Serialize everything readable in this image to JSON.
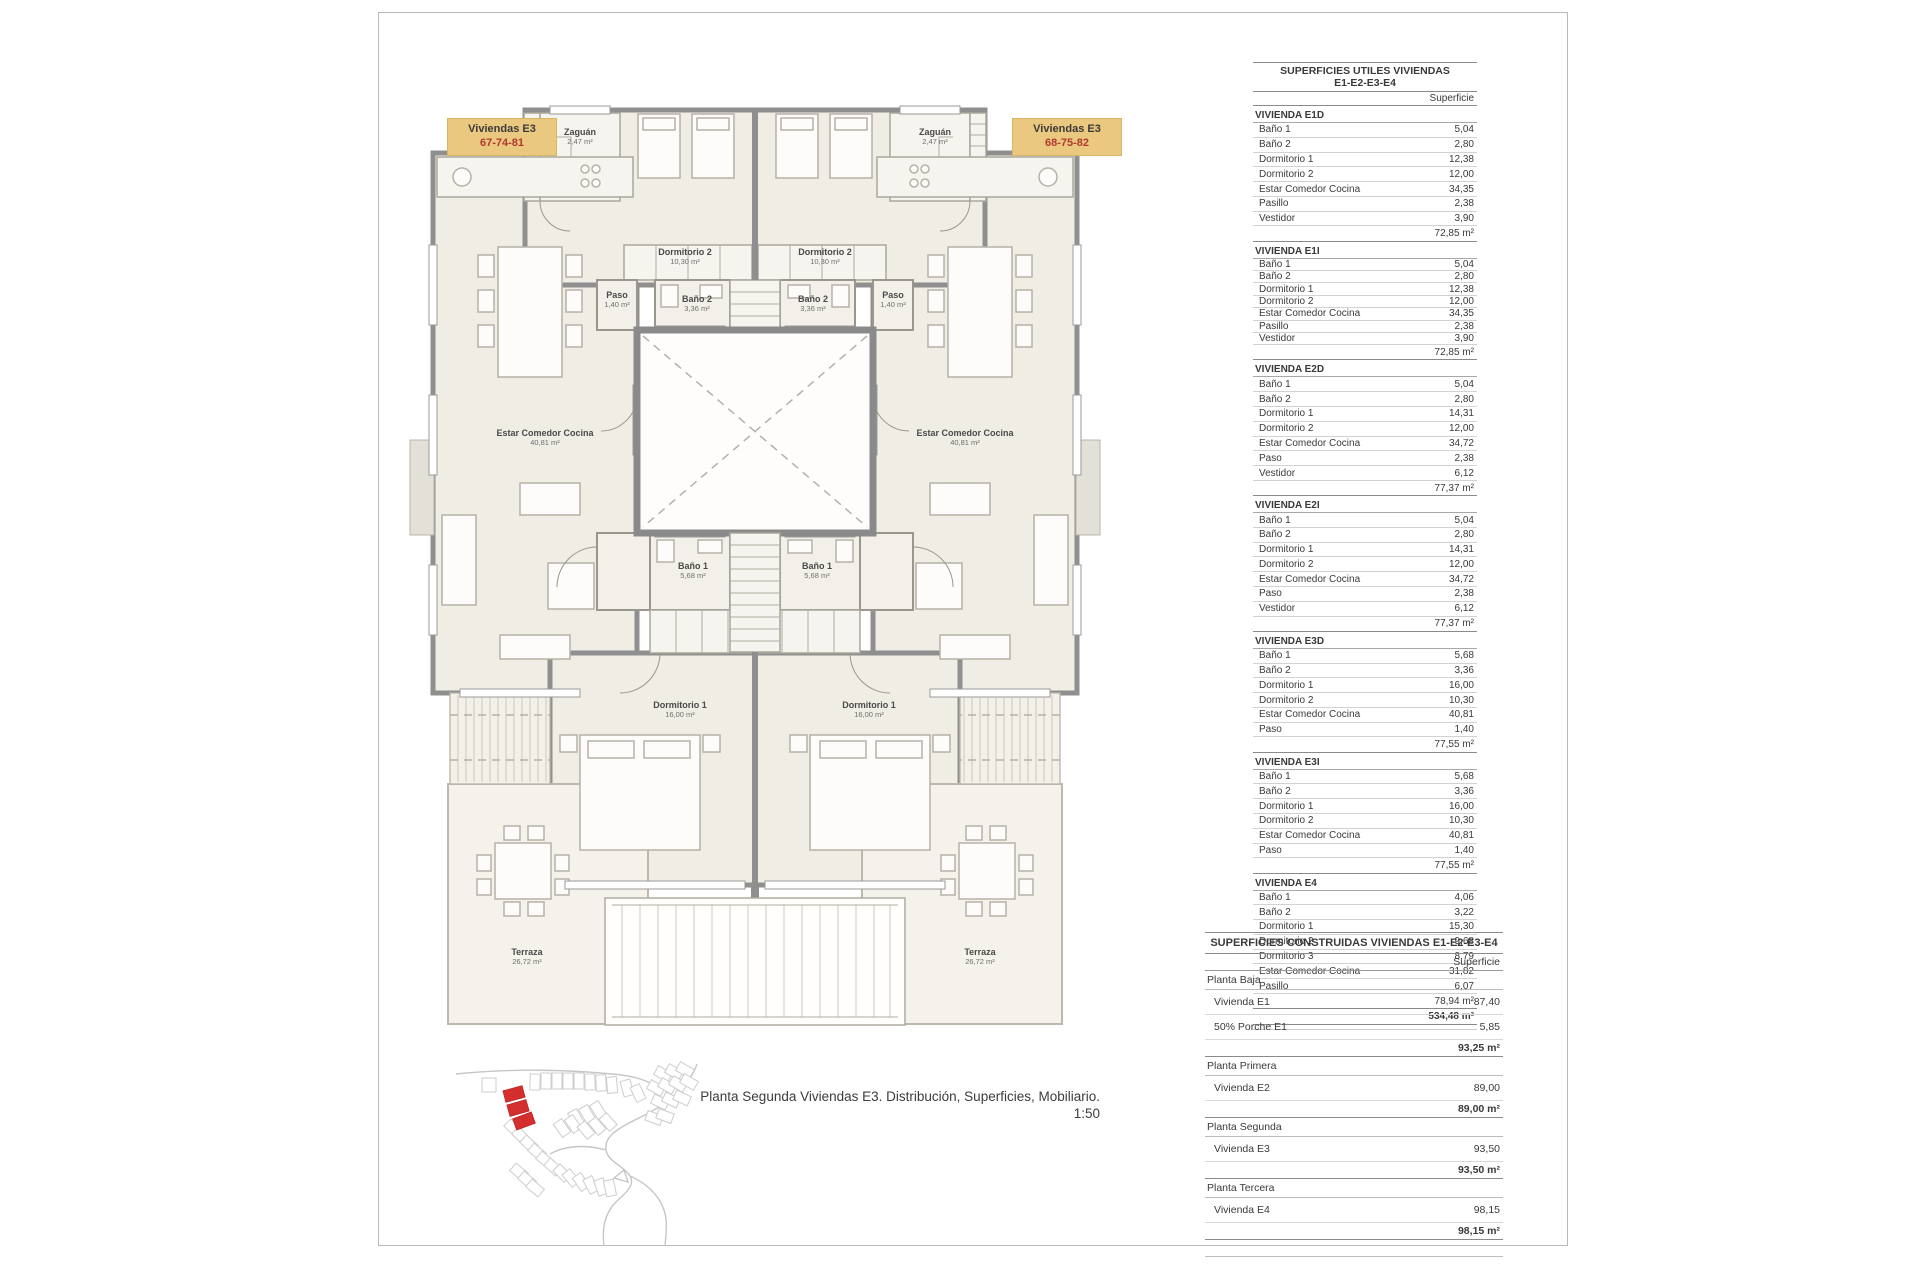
{
  "sheet": {
    "caption_line1": "Planta Segunda Viviendas E3. Distribución, Superficies, Mobiliario.",
    "caption_line2": "1:50"
  },
  "plan": {
    "unit_labels": {
      "left": {
        "title": "Viviendas E3",
        "numbers": "67-74-81"
      },
      "right": {
        "title": "Viviendas E3",
        "numbers": "68-75-82"
      }
    },
    "rooms": {
      "zaguan": {
        "name": "Zaguán",
        "area": "2,47 m²"
      },
      "dormitorio2": {
        "name": "Dormitorio 2",
        "area": "10,30 m²"
      },
      "bano2": {
        "name": "Baño 2",
        "area": "3,36 m²"
      },
      "paso": {
        "name": "Paso",
        "area": "1,40 m²"
      },
      "estar": {
        "name": "Estar Comedor Cocina",
        "area": "40,81 m²"
      },
      "bano1": {
        "name": "Baño 1",
        "area": "5,68 m²"
      },
      "dormitorio1": {
        "name": "Dormitorio 1",
        "area": "16,00 m²"
      },
      "terraza": {
        "name": "Terraza",
        "area": "26,72 m²"
      }
    },
    "colors": {
      "label_box_bg": "#eac87f",
      "label_numbers_red": "#b03a2e",
      "wall_gray": "#8f8f8f",
      "room_fill": "#f0ede5",
      "site_highlight_red": "#d32f2f"
    }
  },
  "tables": {
    "utiles": {
      "title_line1": "SUPERFICIES UTILES VIVIENDAS",
      "title_line2": "E1-E2-E3-E4",
      "col_header": "Superficie",
      "sections": [
        {
          "name": "VIVIENDA E1D",
          "rows": [
            [
              "Baño 1",
              "5,04"
            ],
            [
              "Baño 2",
              "2,80"
            ],
            [
              "Dormitorio 1",
              "12,38"
            ],
            [
              "Dormitorio 2",
              "12,00"
            ],
            [
              "Estar Comedor Cocina",
              "34,35"
            ],
            [
              "Pasillo",
              "2,38"
            ],
            [
              "Vestidor",
              "3,90"
            ]
          ],
          "total": "72,85 m²"
        },
        {
          "name": "VIVIENDA E1I",
          "rows": [
            [
              "Baño 1",
              "5,04"
            ],
            [
              "Baño 2",
              "2,80"
            ],
            [
              "Dormitorio 1",
              "12,38"
            ],
            [
              "Dormitorio 2",
              "12,00"
            ],
            [
              "Estar Comedor Cocina",
              "34,35"
            ],
            [
              "Pasillo",
              "2,38"
            ],
            [
              "Vestidor",
              "3,90"
            ]
          ],
          "total": "72,85 m²"
        },
        {
          "name": "VIVIENDA E2D",
          "rows": [
            [
              "Baño 1",
              "5,04"
            ],
            [
              "Baño 2",
              "2,80"
            ],
            [
              "Dormitorio 1",
              "14,31"
            ],
            [
              "Dormitorio 2",
              "12,00"
            ],
            [
              "Estar Comedor Cocina",
              "34,72"
            ],
            [
              "Paso",
              "2,38"
            ],
            [
              "Vestidor",
              "6,12"
            ]
          ],
          "total": "77,37 m²"
        },
        {
          "name": "VIVIENDA E2I",
          "rows": [
            [
              "Baño 1",
              "5,04"
            ],
            [
              "Baño 2",
              "2,80"
            ],
            [
              "Dormitorio 1",
              "14,31"
            ],
            [
              "Dormitorio 2",
              "12,00"
            ],
            [
              "Estar Comedor Cocina",
              "34,72"
            ],
            [
              "Paso",
              "2,38"
            ],
            [
              "Vestidor",
              "6,12"
            ]
          ],
          "total": "77,37 m²"
        },
        {
          "name": "VIVIENDA E3D",
          "rows": [
            [
              "Baño 1",
              "5,68"
            ],
            [
              "Baño 2",
              "3,36"
            ],
            [
              "Dormitorio 1",
              "16,00"
            ],
            [
              "Dormitorio 2",
              "10,30"
            ],
            [
              "Estar Comedor Cocina",
              "40,81"
            ],
            [
              "Paso",
              "1,40"
            ]
          ],
          "total": "77,55 m²"
        },
        {
          "name": "VIVIENDA E3I",
          "rows": [
            [
              "Baño 1",
              "5,68"
            ],
            [
              "Baño 2",
              "3,36"
            ],
            [
              "Dormitorio 1",
              "16,00"
            ],
            [
              "Dormitorio 2",
              "10,30"
            ],
            [
              "Estar Comedor Cocina",
              "40,81"
            ],
            [
              "Paso",
              "1,40"
            ]
          ],
          "total": "77,55 m²"
        },
        {
          "name": "VIVIENDA E4",
          "rows": [
            [
              "Baño 1",
              "4,06"
            ],
            [
              "Baño 2",
              "3,22"
            ],
            [
              "Dormitorio 1",
              "15,30"
            ],
            [
              "Dormitorio 2",
              "9,68"
            ],
            [
              "Dormitorio 3",
              "8,79"
            ],
            [
              "Estar Comedor Cocina",
              "31,82"
            ],
            [
              "Pasillo",
              "6,07"
            ]
          ],
          "total": "78,94 m²"
        }
      ],
      "grand_total": "534,48 m²"
    },
    "construidas": {
      "title": "SUPERFICIES CONSTRUIDAS VIVIENDAS E1-E2-E3-E4",
      "col_header": "Superficie",
      "groups": [
        {
          "name": "Planta Baja",
          "rows": [
            [
              "Vivienda E1",
              "87,40"
            ],
            [
              "50% Porche E1",
              "5,85"
            ]
          ],
          "total": "93,25 m²"
        },
        {
          "name": "Planta Primera",
          "rows": [
            [
              "Vivienda E2",
              "89,00"
            ]
          ],
          "total": "89,00 m²"
        },
        {
          "name": "Planta Segunda",
          "rows": [
            [
              "Vivienda E3",
              "93,50"
            ]
          ],
          "total": "93,50 m²"
        },
        {
          "name": "Planta Tercera",
          "rows": [
            [
              "Vivienda E4",
              "98,15"
            ]
          ],
          "total": "98,15 m²"
        }
      ]
    }
  }
}
